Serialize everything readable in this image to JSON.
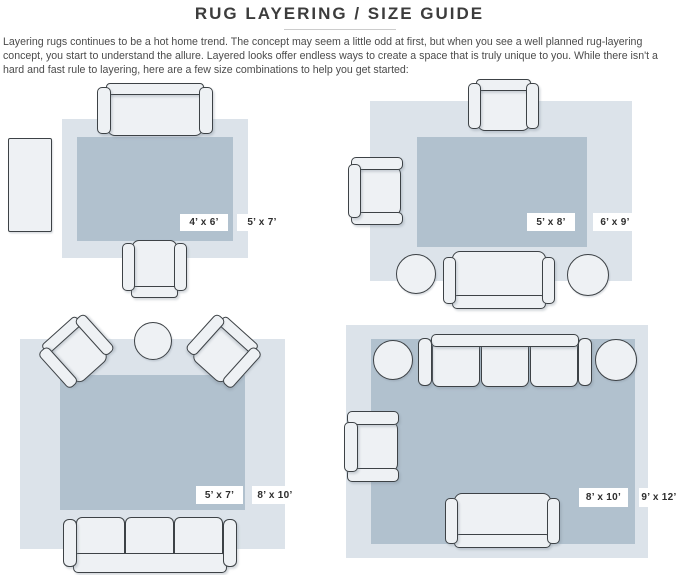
{
  "header": {
    "title": "RUG LAYERING / SIZE GUIDE",
    "intro": "Layering rugs continues to be a hot home trend. The concept may seem a little odd at first, but when you see a well planned rug-layering concept, you start to understand the allure. Layered looks offer endless ways to create a space that is truly unique to you. While there isn't a hard and fast rule to layering, here are a few size combinations to help you get started:"
  },
  "colors": {
    "outer_rug": "#dce3ea",
    "inner_rug": "#b1c1ce",
    "furniture_fill": "#eef1f4",
    "furniture_outline": "#3d4246",
    "label_bg": "#ffffff",
    "title_text": "#3c3c3c",
    "body_text": "#4b4b4b"
  },
  "layouts": [
    {
      "name": "layout-top-left",
      "inner_rug_size": "4’ x 6’",
      "outer_rug_size": "5’ x 7’",
      "furniture": [
        "loveseat",
        "armchair",
        "console-table"
      ]
    },
    {
      "name": "layout-top-right",
      "inner_rug_size": "5’ x 8’",
      "outer_rug_size": "6’ x 9’",
      "furniture": [
        "armchair",
        "armchair",
        "sofa",
        "pouf",
        "pouf"
      ]
    },
    {
      "name": "layout-bottom-left",
      "inner_rug_size": "5’ x 7’",
      "outer_rug_size": "8’ x 10’",
      "furniture": [
        "armchair",
        "armchair",
        "round-table",
        "sofa"
      ]
    },
    {
      "name": "layout-bottom-right",
      "inner_rug_size": "8’ x 10’",
      "outer_rug_size": "9’ x 12’",
      "furniture": [
        "sofa",
        "pouf",
        "pouf",
        "armchair",
        "loveseat"
      ]
    }
  ]
}
